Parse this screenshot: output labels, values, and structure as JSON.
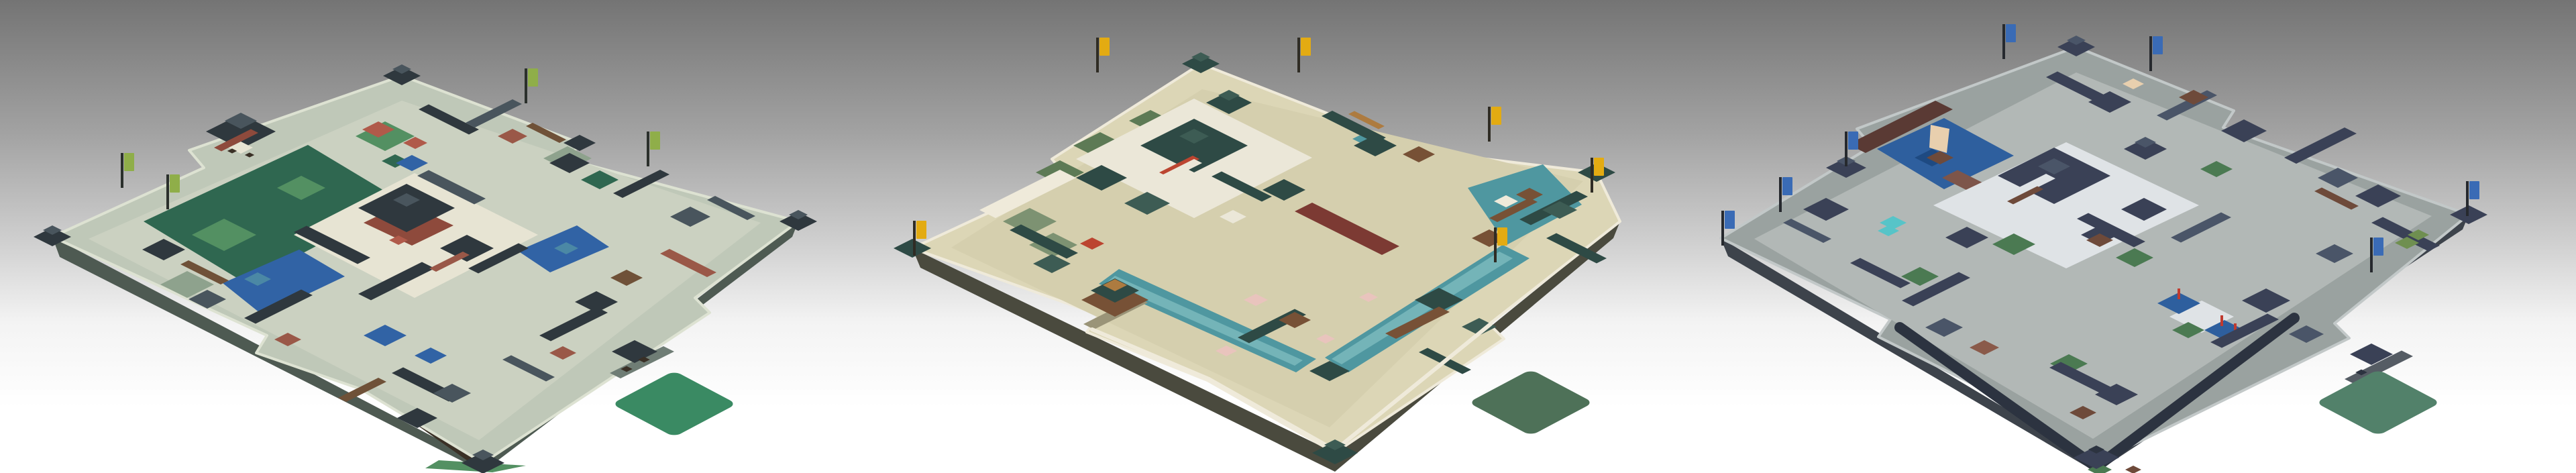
{
  "page": {
    "background_vars": "--bg-top:#747474;--bg-up:#a2a2a2;--bg-mid:#cdcdcd;--bg-low:#f3f3f3;--bg-bottom:#ffffff"
  },
  "maps": [
    {
      "id": "city-map-1",
      "css_vars": "--wall:#bfc8b8;--wall-lit:#dde2d2;--wall-dark:#6f7d75;--skirt:#4e5a52;--ground:#cbd1c1;--park:#2f6750;--park2:#539062;--sage:#8ea28d;--roof-dark:#2f383e;--roof-slate:#49555d;--roof-gray:#5f6d74;--brick:#9a5848;--brown:#6f5138;--timber:#3a3026;--water:#3163a5;--water2:#4b88a5;--court:#e7e4d3;--palace-wall:#8e4a3c;--flag:#8fae49;--pole:#2b302c;--accent:#b05a4a;--accent2:#6f9178;--red:#a33c30;--sail:#e7e4d3",
      "flag_color": "#8fae49",
      "flag_count": 4,
      "diamond_color": "#3a8a63"
    },
    {
      "id": "city-map-2",
      "css_vars": "--wall:#dcd6b6;--wall-lit:#efeada;--wall-dark:#9a9478;--skirt:#4a4a3e;--ground:#d5cfae;--park:#5d7a55;--park2:#6f8f60;--sage:#7d9272;--roof-dark:#2e4a45;--roof-slate:#3d5c54;--roof-gray:#39464a;--brick:#bc4530;--brown:#775136;--timber:#4a3226;--water:#4f97a0;--water2:#74b4b8;--court:#ebe7d8;--palace-wall:#7c3a33;--flag:#e3ab12;--pole:#2f2c24;--accent:#e9c4bd;--accent2:#ad7b40;--red:#bc4530;--sail:#e8d8a8",
      "flag_color": "#e3ab12",
      "flag_count": 6,
      "diamond_color": "#4e7158"
    },
    {
      "id": "city-map-3",
      "css_vars": "--wall:#9aa2a0;--wall-lit:#c2c8c8;--wall-dark:#555c64;--skirt:#3d434b;--ground:#b2b8b6;--park:#4b7a52;--park2:#6f8f50;--sage:#7c8a7e;--roof-dark:#3a4156;--roof-slate:#4a5568;--roof-gray:#343b4e;--brick:#8a5a4a;--brown:#6e4a3a;--timber:#2c3340;--water:#2e5f9e;--water2:#1e4a82;--court:#dfe3e6;--palace-wall:#5a3a34;--flag:#3a6bb5;--pole:#26292e;--accent:#57c4c8;--accent2:#7d554a;--red:#c03b30;--sail:#e8cfae",
      "flag_color": "#3a6bb5",
      "flag_count": 7,
      "diamond_color": "#52816a"
    }
  ]
}
